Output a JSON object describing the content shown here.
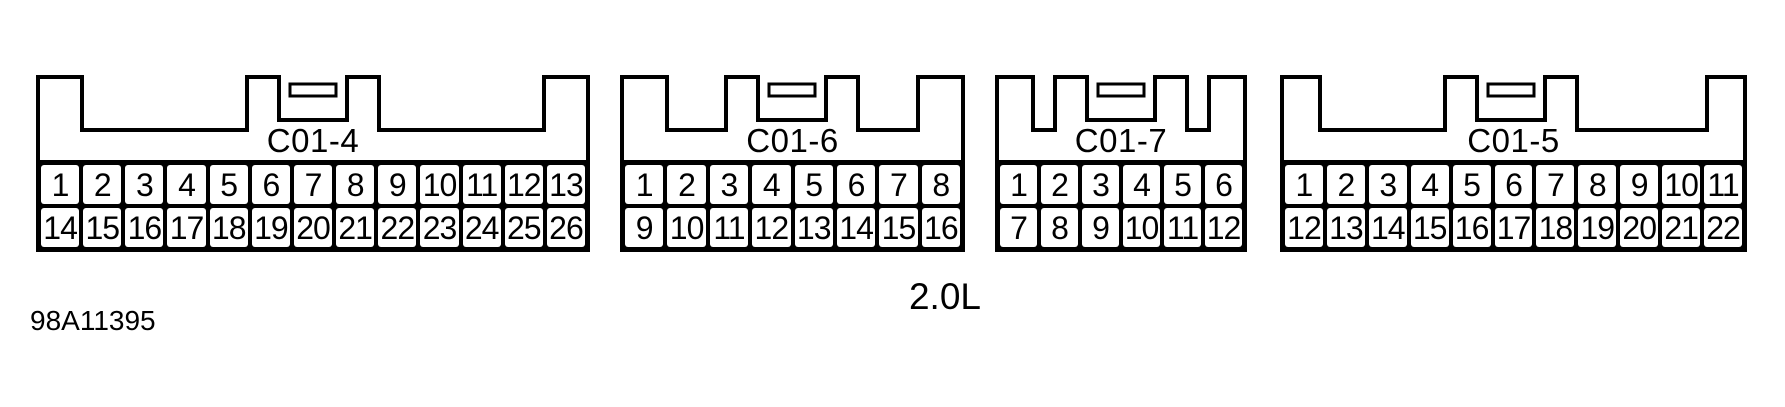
{
  "diagram": {
    "engine_label": "2.0L",
    "figure_number": "98A11395"
  },
  "connectors": [
    {
      "label": "C01-4",
      "top_row": [
        "1",
        "2",
        "3",
        "4",
        "5",
        "6",
        "7",
        "8",
        "9",
        "10",
        "11",
        "12",
        "13"
      ],
      "bottom_row": [
        "14",
        "15",
        "16",
        "17",
        "18",
        "19",
        "20",
        "21",
        "22",
        "23",
        "24",
        "25",
        "26"
      ]
    },
    {
      "label": "C01-6",
      "top_row": [
        "1",
        "2",
        "3",
        "4",
        "5",
        "6",
        "7",
        "8"
      ],
      "bottom_row": [
        "9",
        "10",
        "11",
        "12",
        "13",
        "14",
        "15",
        "16"
      ]
    },
    {
      "label": "C01-7",
      "top_row": [
        "1",
        "2",
        "3",
        "4",
        "5",
        "6"
      ],
      "bottom_row": [
        "7",
        "8",
        "9",
        "10",
        "11",
        "12"
      ]
    },
    {
      "label": "C01-5",
      "top_row": [
        "1",
        "2",
        "3",
        "4",
        "5",
        "6",
        "7",
        "8",
        "9",
        "10",
        "11"
      ],
      "bottom_row": [
        "12",
        "13",
        "14",
        "15",
        "16",
        "17",
        "18",
        "19",
        "20",
        "21",
        "22"
      ]
    }
  ],
  "colors": {
    "line": "#000000",
    "background": "#ffffff"
  }
}
